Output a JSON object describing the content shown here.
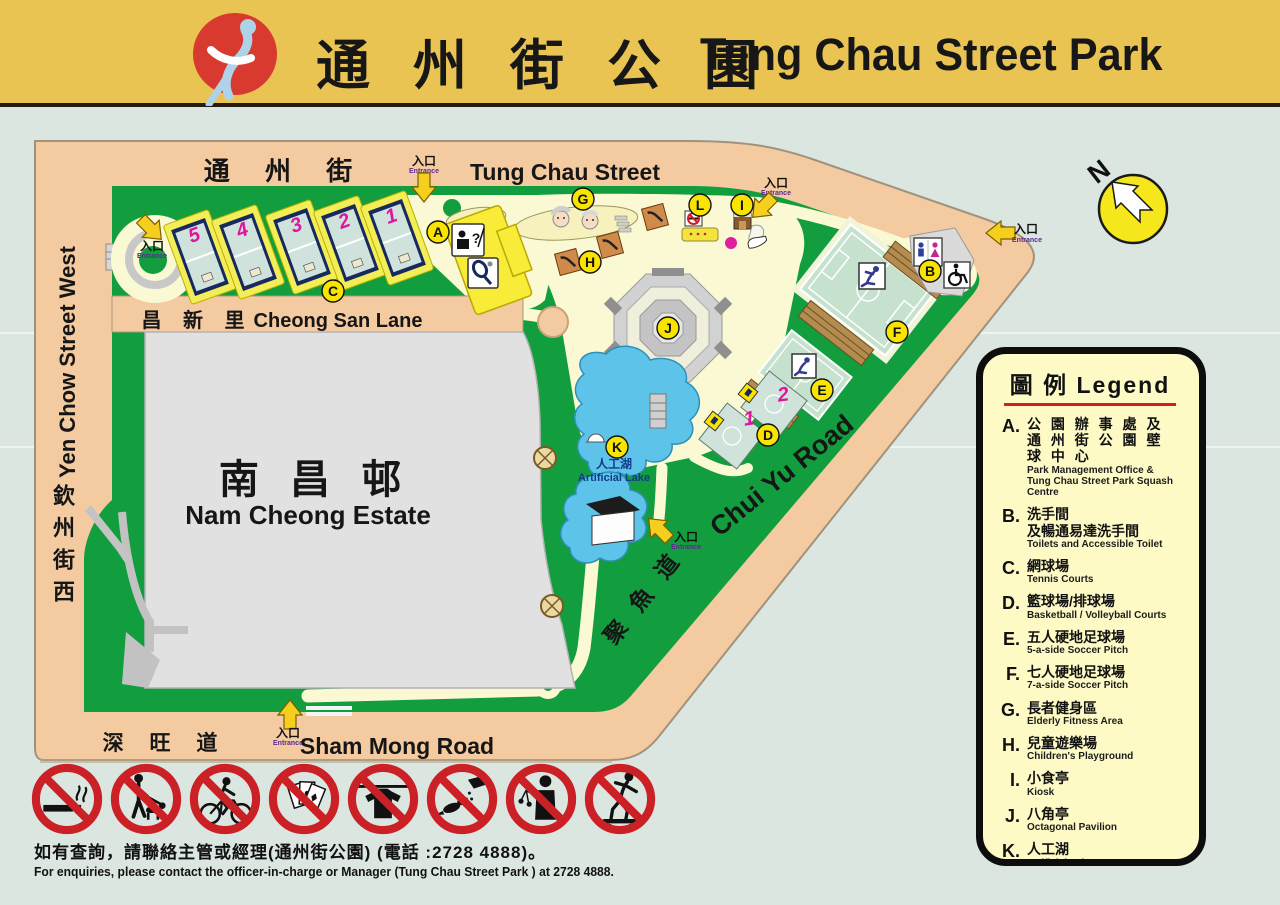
{
  "header": {
    "title_zh": "通 州 街 公 園",
    "title_en": "Tung Chau Street Park"
  },
  "north_label": "N",
  "entrance": {
    "zh": "入口",
    "en": "Entrance"
  },
  "streets": {
    "tung_chau_zh": "通 州 街",
    "tung_chau_en": "Tung Chau Street",
    "cheong_san_zh": "昌 新 里",
    "cheong_san_en": "Cheong San Lane",
    "yen_chow_zh": "欽州街西",
    "yen_chow_en": "Yen Chow Street West",
    "sham_mong_zh": "深 旺 道",
    "sham_mong_en": "Sham Mong Road",
    "chui_yu_zh": "聚 魚 道",
    "chui_yu_en": "Chui Yu Road"
  },
  "estate": {
    "zh": "南 昌 邨",
    "en": "Nam Cheong Estate"
  },
  "lake": {
    "zh": "人工湖",
    "en": "Artificial Lake"
  },
  "markers": [
    "A",
    "B",
    "C",
    "D",
    "E",
    "F",
    "G",
    "H",
    "I",
    "J",
    "K",
    "L"
  ],
  "tennis_court_numbers": [
    "5",
    "4",
    "3",
    "2",
    "1"
  ],
  "basketball_court_numbers": [
    "1",
    "2"
  ],
  "legend": {
    "title": "圖 例 Legend",
    "items": [
      {
        "key": "A.",
        "zh": "公 園 辦 事 處 及",
        "zh2": "通 州 街 公 園 壁 球 中 心",
        "en": "Park Management Office &",
        "en2": "Tung Chau Street Park Squash Centre"
      },
      {
        "key": "B.",
        "zh": "洗手間",
        "zh2": "及暢通易達洗手間",
        "en": "Toilets and Accessible Toilet"
      },
      {
        "key": "C.",
        "zh": "網球場",
        "en": "Tennis Courts"
      },
      {
        "key": "D.",
        "zh": "籃球場/排球場",
        "en": "Basketball / Volleyball Courts"
      },
      {
        "key": "E.",
        "zh": "五人硬地足球場",
        "en": "5-a-side Soccer Pitch"
      },
      {
        "key": "F.",
        "zh": "七人硬地足球場",
        "en": "7-a-side Soccer Pitch"
      },
      {
        "key": "G.",
        "zh": "長者健身區",
        "en": "Elderly Fitness Area"
      },
      {
        "key": "H.",
        "zh": "兒童遊樂場",
        "en": "Children's Playground"
      },
      {
        "key": "I.",
        "zh": "小食亭",
        "en": "Kiosk"
      },
      {
        "key": "J.",
        "zh": "八角亭",
        "en": "Octagonal Pavilion"
      },
      {
        "key": "K.",
        "zh": "人工湖",
        "en": "Artificial Lake"
      },
      {
        "key": "L.",
        "zh": "吸煙區",
        "en": "Smoking Area"
      }
    ]
  },
  "prohibition_icons": [
    "no-smoking",
    "no-dog-walking",
    "no-cycling",
    "no-gambling",
    "no-clothes-drying",
    "no-bird-feeding",
    "no-hawking",
    "no-skateboarding"
  ],
  "footer": {
    "zh": "如有查詢，請聯絡主管或經理(通州街公園) (電話 :2728 4888)。",
    "en": "For enquiries, please contact the officer-in-charge or Manager (Tung Chau Street Park )  at 2728 4888."
  },
  "colors": {
    "header_gold": "#e9c452",
    "road_tan": "#f4caa0",
    "park_green": "#129e3e",
    "path_cream": "#faf9d4",
    "lake_blue": "#5ec3e9",
    "legend_bg": "#fdfac6",
    "marker_yellow": "#f9e400",
    "prohibition_red": "#cb2026",
    "estate_gray": "#e1e1e1",
    "background": "#dbe6e1",
    "court_magenta": "#e0149e"
  }
}
